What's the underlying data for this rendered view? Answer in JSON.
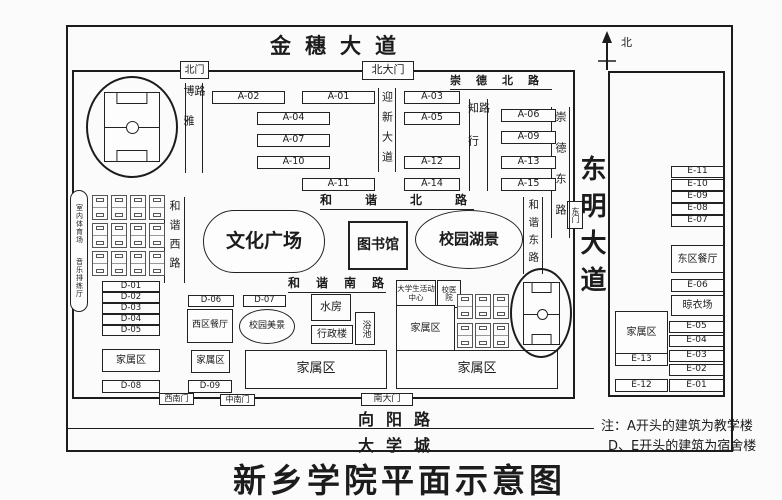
{
  "title": "新乡学院平面示意图",
  "compass": {
    "north_label": "北"
  },
  "colors": {
    "ink": "#1c1c1c",
    "paper": "#fbfbfb"
  },
  "roads": {
    "jinsui": "金穗大道",
    "chongde_north": "崇德北路",
    "boya": "博雅路",
    "yingxin": "迎新大道",
    "zhixing": "知行路",
    "chongde_east": "崇德东路",
    "hexie_west": "和谐西路",
    "hexie_north": "和谐北路",
    "hexie_south": "和谐南路",
    "hexie_east": "和谐东路",
    "dongming": "东明大道",
    "xiangyang": "向阳路",
    "daxuecheng": "大学城"
  },
  "gates": {
    "north": "北门",
    "north_main": "北大门",
    "east": "东门",
    "southwest": "西南门",
    "south_middle": "中南门",
    "south_main": "南大门"
  },
  "b": {
    "a01": "A-01",
    "a02": "A-02",
    "a03": "A-03",
    "a04": "A-04",
    "a05": "A-05",
    "a06": "A-06",
    "a07": "A-07",
    "a09": "A-09",
    "a10": "A-10",
    "a11": "A-11",
    "a12": "A-12",
    "a13": "A-13",
    "a14": "A-14",
    "a15": "A-15",
    "d01": "D-01",
    "d02": "D-02",
    "d03": "D-03",
    "d04": "D-04",
    "d05": "D-05",
    "d06": "D-06",
    "d07": "D-07",
    "d08": "D-08",
    "d09": "D-09",
    "e01": "E-01",
    "e02": "E-02",
    "e03": "E-03",
    "e04": "E-04",
    "e05": "E-05",
    "e06": "E-06",
    "e07": "E-07",
    "e08": "E-08",
    "e09": "E-09",
    "e10": "E-10",
    "e11": "E-11",
    "e12": "E-12",
    "e13": "E-13"
  },
  "f": {
    "culture_square": "文化广场",
    "library": "图书馆",
    "campus_lake": "校园湖景",
    "campus_beauty": "校园美景",
    "west_dining": "西区餐厅",
    "east_dining": "东区餐厅",
    "water_room": "水房",
    "admin_building": "行政楼",
    "bath": "浴池",
    "student_center": "大学生活动中心",
    "hospital": "校医院",
    "drying_yard": "晾衣场",
    "family_area": "家属区",
    "indoor_gym": "室内体育场",
    "music_hall": "音乐排练厅"
  },
  "note": {
    "line1": "注：A开头的建筑为教学楼",
    "line2": "D、E开头的建筑为宿舍楼"
  }
}
